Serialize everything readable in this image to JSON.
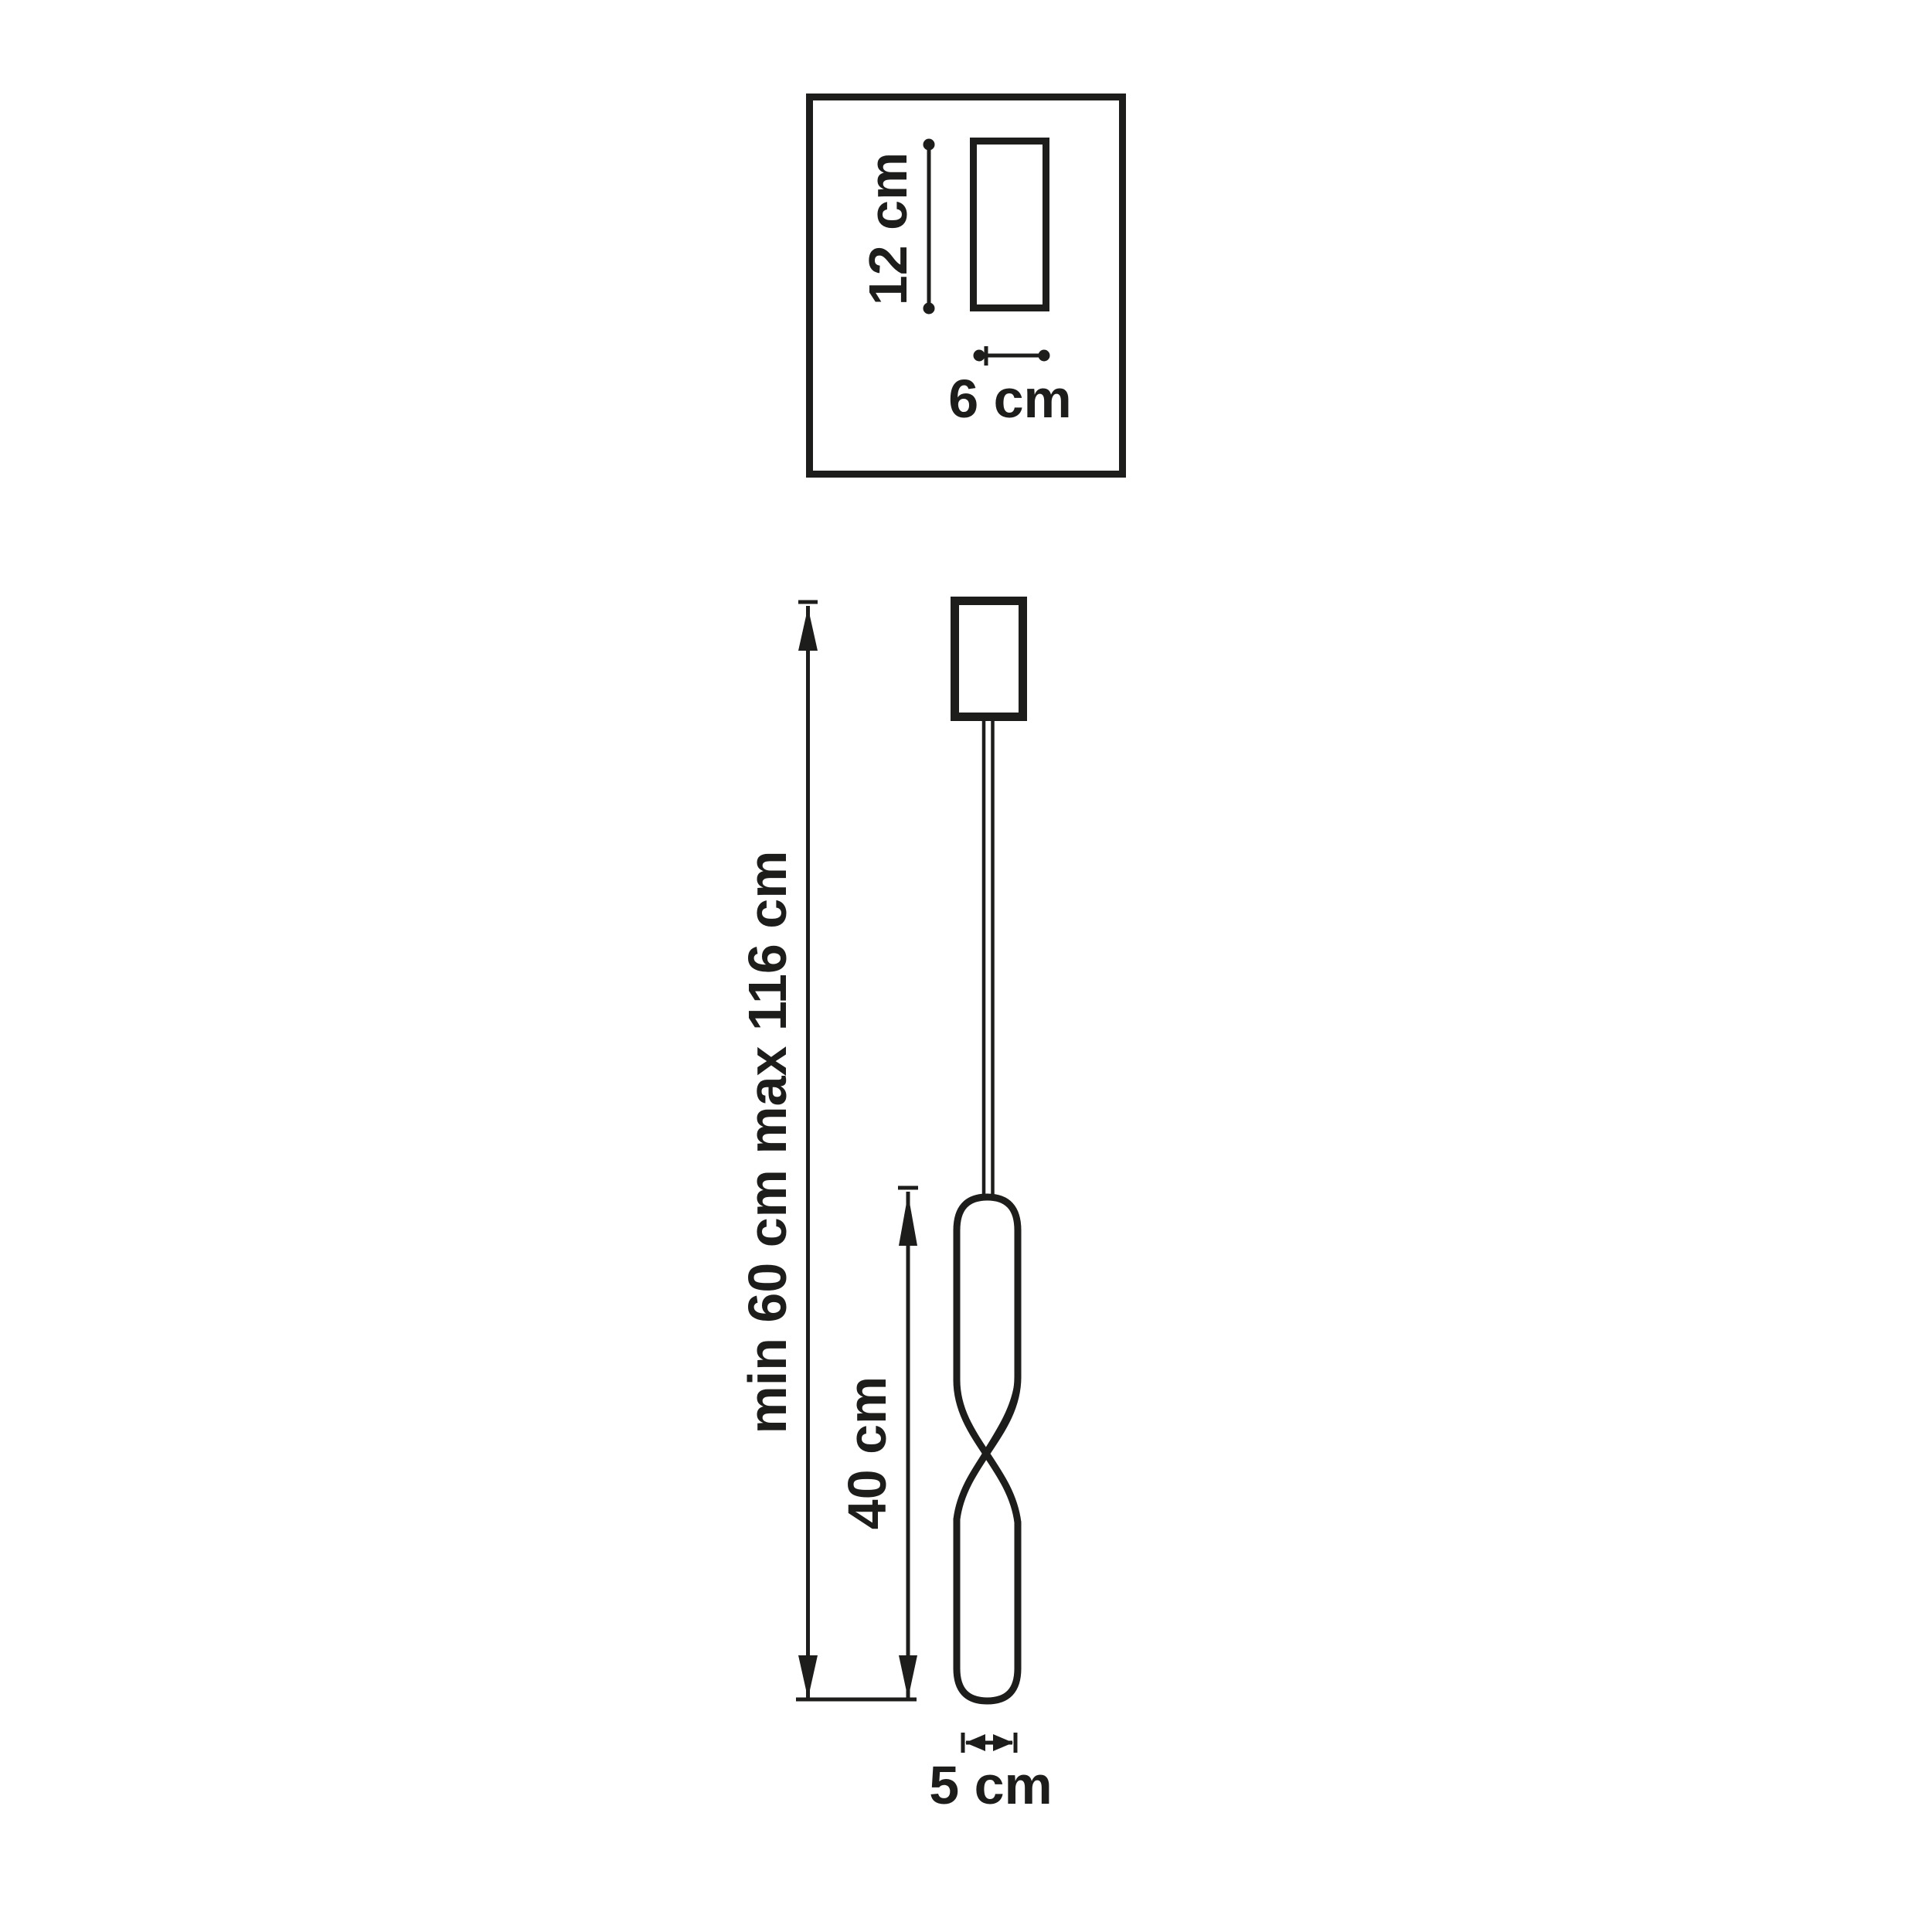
{
  "colors": {
    "ink": "#1d1d1b",
    "background": "#ffffff"
  },
  "top_view": {
    "height_label": "12 cm",
    "width_label": "6 cm"
  },
  "side_view": {
    "suspension_height_label": "min 60 cm max 116 cm",
    "body_height_label": "40 cm",
    "body_diameter_label": "5 cm"
  }
}
